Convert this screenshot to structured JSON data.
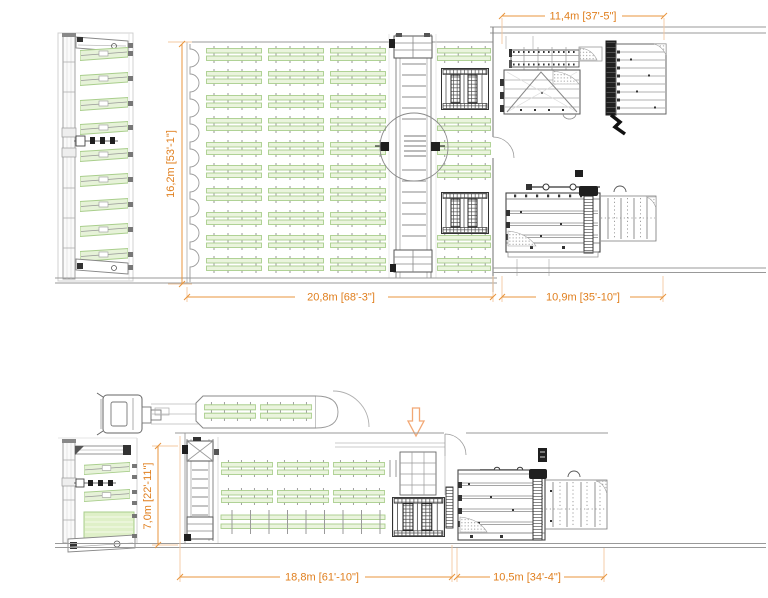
{
  "drawing": {
    "dimensions": {
      "machines_width_top": "11,4m [37'-5\"]",
      "hall_depth_top": "16,2m [53'-1\"]",
      "hall_width_top": "20,8m [68'-3\"]",
      "machine_area_width_top": "10,9m [35'-10\"]",
      "hall_depth_bottom": "7,0m [22'-11\"]",
      "hall_width_bottom": "18,8m [61'-10\"]",
      "machine_area_width_bottom": "10,5m [34'-4\"]"
    },
    "colors": {
      "dimension_text": "#e07f1e",
      "dimension_line": "#e8943c",
      "extension_line": "#f3c9a0",
      "tray_fill": "#e6f2d8",
      "tray_stroke": "#a9ce8c",
      "drawing_line_light": "#9a9a9a",
      "drawing_line_dark": "#1f1f1f",
      "flow_arrow": "#f2a875",
      "background": "#ffffff"
    },
    "icons": {
      "flow_arrow": "down-arrow"
    }
  }
}
